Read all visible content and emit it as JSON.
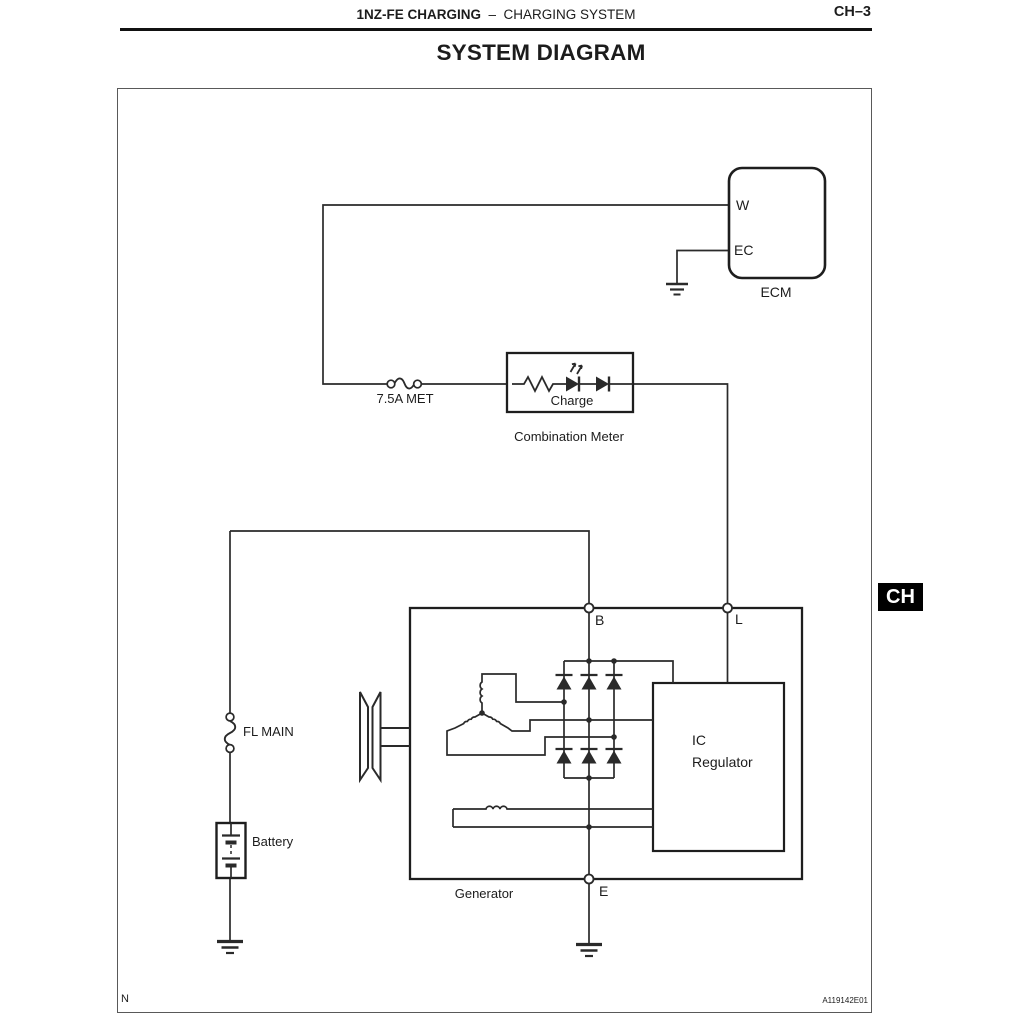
{
  "header": {
    "left_bold": "1NZ-FE CHARGING",
    "dash": "–",
    "left_regular": "CHARGING SYSTEM",
    "page": "CH–3"
  },
  "title": "SYSTEM DIAGRAM",
  "side_tab": "CH",
  "footer": {
    "left": "N",
    "code": "A119142E01"
  },
  "labels": {
    "ecm": "ECM",
    "terminal_w": "W",
    "terminal_ec": "EC",
    "fuse": "7.5A MET",
    "charge": "Charge",
    "combination_meter": "Combination Meter",
    "fl_main": "FL MAIN",
    "battery": "Battery",
    "generator": "Generator",
    "terminal_b": "B",
    "terminal_l": "L",
    "terminal_e": "E",
    "ic_regulator_line1": "IC",
    "ic_regulator_line2": "Regulator"
  },
  "colors": {
    "line": "#2a2a2a",
    "frame": "#595959",
    "tab_bg": "#000000",
    "tab_fg": "#ffffff"
  }
}
